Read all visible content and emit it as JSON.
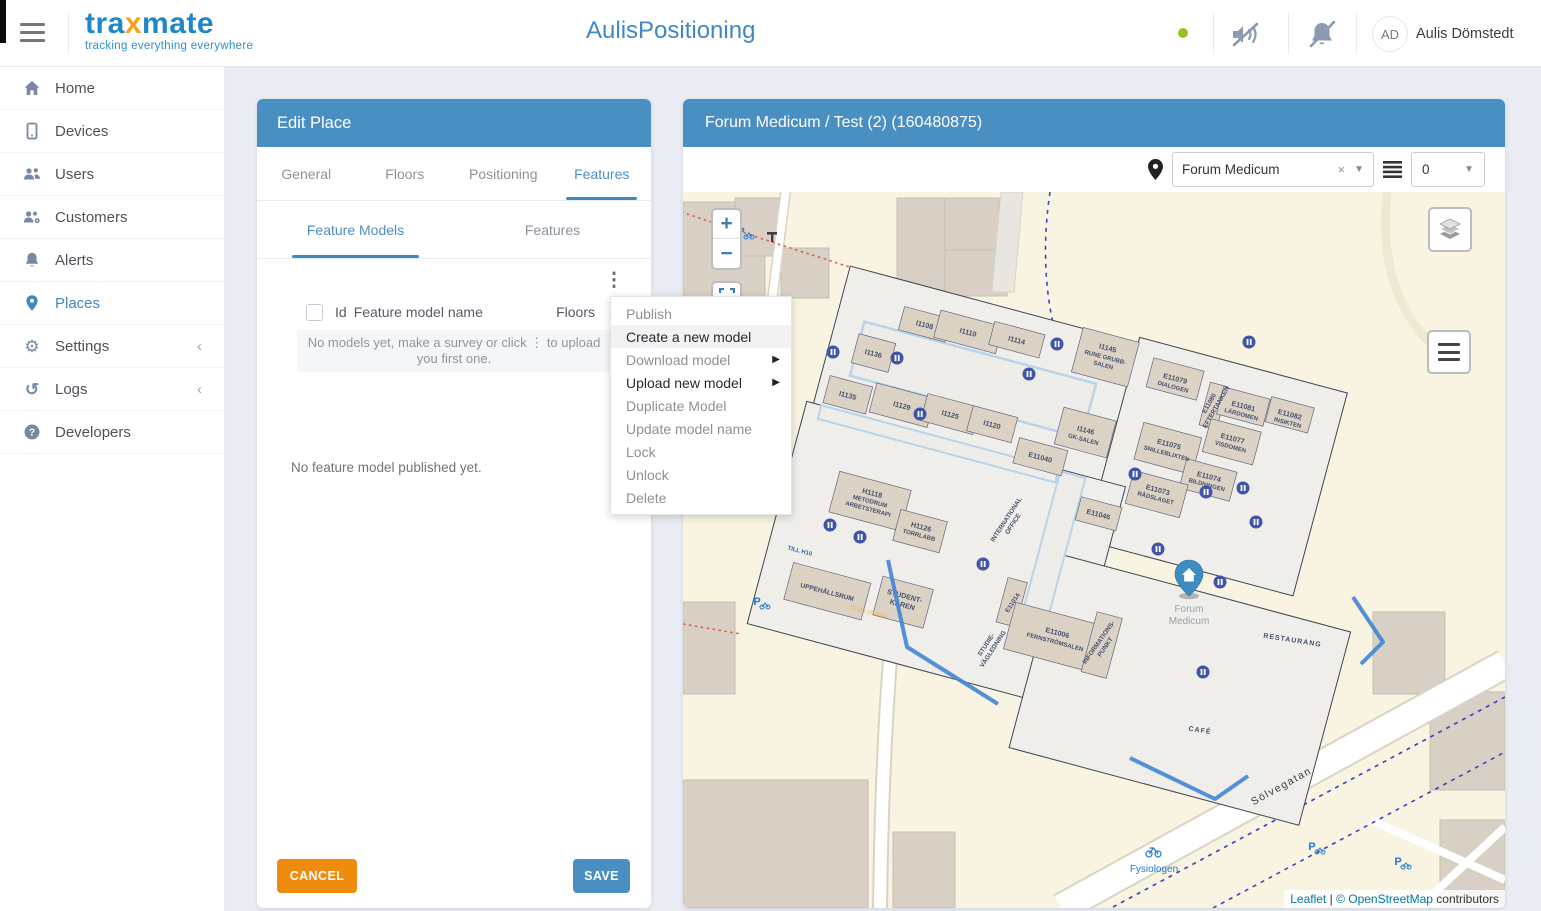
{
  "header": {
    "brand": "tra",
    "brand_x": "x",
    "brand_rest": "mate",
    "brand_tagline": "tracking everything everywhere",
    "app_title": "AulisPositioning",
    "user_initials": "AD",
    "user_name": "Aulis Dömstedt"
  },
  "sidebar": {
    "items": [
      {
        "label": "Home"
      },
      {
        "label": "Devices"
      },
      {
        "label": "Users"
      },
      {
        "label": "Customers"
      },
      {
        "label": "Alerts"
      },
      {
        "label": "Places"
      },
      {
        "label": "Settings"
      },
      {
        "label": "Logs"
      },
      {
        "label": "Developers"
      }
    ],
    "collapse_chevron": "‹"
  },
  "edit_place": {
    "title": "Edit Place",
    "tabs": [
      {
        "label": "General"
      },
      {
        "label": "Floors"
      },
      {
        "label": "Positioning"
      },
      {
        "label": "Features"
      }
    ],
    "subtabs": [
      {
        "label": "Feature Models"
      },
      {
        "label": "Features"
      }
    ],
    "table_headers": {
      "id": "Id",
      "name": "Feature model name",
      "floors": "Floors"
    },
    "empty_models_line1": "No models yet, make a survey or click ⋮ to upload",
    "empty_models_line2": "you first one.",
    "no_published": "No feature model published yet.",
    "cancel": "CANCEL",
    "save": "SAVE",
    "kebab": "⋮"
  },
  "context_menu": {
    "items": [
      {
        "label": "Publish"
      },
      {
        "label": "Create a new model"
      },
      {
        "label": "Download model"
      },
      {
        "label": "Upload new model"
      },
      {
        "label": "Duplicate Model"
      },
      {
        "label": "Update model name"
      },
      {
        "label": "Lock"
      },
      {
        "label": "Unlock"
      },
      {
        "label": "Delete"
      }
    ],
    "submenu_arrow": "▶"
  },
  "map_panel": {
    "title": "Forum Medicum / Test (2) (160480875)",
    "place_select_value": "Forum Medicum",
    "clear_x": "×",
    "caret": "▼",
    "floor_select_value": "0",
    "zoom_in": "+",
    "zoom_out": "−",
    "attribution_leaflet": "Leaflet",
    "attribution_sep": "|",
    "attribution_osm": "© OpenStreetMap",
    "attribution_suffix": "contributors"
  },
  "map": {
    "marker_place_line1": "Forum",
    "marker_place_line2": "Medicum",
    "street": "Sölvegatan",
    "poi_fysiologen": "Fysiologen",
    "parking": "P",
    "watermark": "traxmate",
    "rooms": {
      "i1108": "I1108",
      "i1110": "I1110",
      "i1114": "I1114",
      "i1136": "I1136",
      "i1135": "I1135",
      "i1129": "I1129",
      "i1125": "I1125",
      "i1120": "I1120",
      "e11040": "E11040",
      "i1145": "I1145",
      "i1145_n1": "RUNE GRUBB-",
      "i1145_n2": "SALEN",
      "i1146": "I1146",
      "i1146_n": "GK-SALEN",
      "e11079": "E11079",
      "e11079_n": "DIALOGEN",
      "e11080": "E11080",
      "e11080_n": "EFTERTANKEN",
      "e11081": "E11081",
      "e11081_n": "LÄRDOMEN",
      "e11082": "E11082",
      "e11082_n": "INSIKTEN",
      "e11075": "E11075",
      "e11075_n": "SNILLEBLIXTEN",
      "e11077": "E11077",
      "e11077_n": "VISDOMEN",
      "e11074": "E11074",
      "e11074_n": "BILDNINGEN",
      "e11073": "E11073",
      "e11073_n": "RÅDSLAGET",
      "e11046": "E11046",
      "h1118": "H1118",
      "h1118_n1": "METODRUM",
      "h1118_n2": "ARBETSTERAPI",
      "h1126": "H1126",
      "h1126_n": "TORRLABB",
      "intl_1": "INTERNATIONAL",
      "intl_2": "OFFICE",
      "till_h10": "TILL H10",
      "uppehallsrum": "UPPEHÅLLSRUM",
      "student_1": "STUDENT-",
      "student_2": "KÅREN",
      "e11014": "E11014",
      "studie_1": "STUDIE-",
      "studie_2": "VÄGLEDNING",
      "e11006": "E11006",
      "e11006_n": "FERNSTRÖMSALEN",
      "info_1": "INFORMATIONS-",
      "info_2": "PUNKT",
      "restaurang": "RESTAURANG",
      "cafe": "CAFÉ"
    }
  }
}
